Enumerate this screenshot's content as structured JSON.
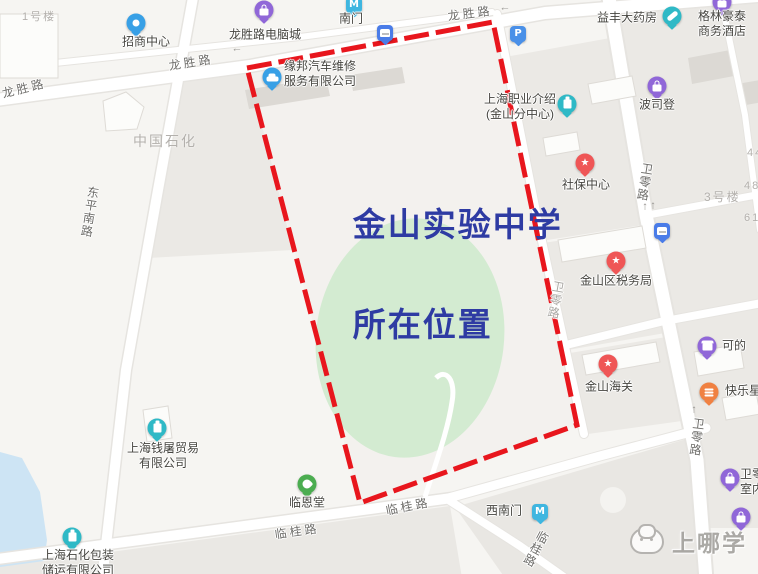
{
  "map": {
    "caption": {
      "line1": "金山实验中学",
      "line2": "所在位置"
    },
    "watermark": {
      "text": "上哪学"
    },
    "colors": {
      "boundary_red": "#e8161d",
      "caption_blue": "#2e3ba3",
      "field_green": "#d3ebd1",
      "water_blue": "#cde4f4",
      "block_grey": "#ebe9e5",
      "road_white": "#ffffff"
    },
    "road_labels": [
      {
        "id": "longsheng-road-west",
        "text": "龙胜路",
        "x": 24,
        "y": 88,
        "rot": -14
      },
      {
        "id": "longsheng-road-mid",
        "text": "龙胜路",
        "x": 191,
        "y": 62,
        "rot": -9
      },
      {
        "id": "longsheng-road-east",
        "text": "龙胜路",
        "x": 470,
        "y": 13,
        "rot": -7
      },
      {
        "id": "dongping-south-road",
        "text": "东平南路",
        "x": 90,
        "y": 212,
        "rot": 9,
        "vertical": true
      },
      {
        "id": "weiling-road-north",
        "text": "卫零路",
        "x": 645,
        "y": 182,
        "rot": 9,
        "vertical": true
      },
      {
        "id": "weiling-road-south",
        "text": "卫零路",
        "x": 697,
        "y": 437,
        "rot": 7,
        "vertical": true
      },
      {
        "id": "weiling-road-inner",
        "text": "卫零路",
        "x": 556,
        "y": 300,
        "rot": 10,
        "vertical": true,
        "muted": true
      },
      {
        "id": "lingui-road-west",
        "text": "临桂路",
        "x": 297,
        "y": 531,
        "rot": -8
      },
      {
        "id": "lingui-road-mid",
        "text": "临桂路",
        "x": 408,
        "y": 506,
        "rot": -11
      },
      {
        "id": "lingui-road-south",
        "text": "临桂路",
        "x": 536,
        "y": 549,
        "rot": 28,
        "vertical": true
      }
    ],
    "area_labels": [
      {
        "id": "sinopec-area",
        "text": "中国石化",
        "x": 133,
        "y": 131,
        "size": 14
      },
      {
        "id": "building-no1",
        "text": "1号楼",
        "x": 22,
        "y": 8,
        "size": 11
      },
      {
        "id": "building-no3",
        "text": "3号楼",
        "x": 704,
        "y": 188,
        "size": 12
      },
      {
        "id": "building-no44",
        "text": "44号",
        "x": 747,
        "y": 144,
        "size": 11
      },
      {
        "id": "building-no48",
        "text": "48号",
        "x": 744,
        "y": 177,
        "size": 11
      },
      {
        "id": "building-no61",
        "text": "61号",
        "x": 744,
        "y": 209,
        "size": 11
      }
    ],
    "arrows": [
      {
        "glyph": "←",
        "x": 237,
        "y": 49
      },
      {
        "glyph": "←",
        "x": 505,
        "y": 8
      },
      {
        "glyph": "↑",
        "x": 645,
        "y": 207
      },
      {
        "glyph": "↑",
        "x": 653,
        "y": 206
      },
      {
        "glyph": "↑",
        "x": 694,
        "y": 410
      }
    ],
    "pois": [
      {
        "id": "zhaoshang-center",
        "label": "招商中心",
        "icon": "dot",
        "color": "#38a0e6",
        "x": 136,
        "y": 23,
        "lx": 146,
        "ly": 42
      },
      {
        "id": "longshenglu-computer-city",
        "label": "龙胜路电脑城",
        "icon": "bag",
        "color": "#9067d8",
        "x": 264,
        "y": 10,
        "lx": 265,
        "ly": 35
      },
      {
        "id": "nanmen-metro",
        "label": "南门",
        "icon": "metro",
        "glyph": "M",
        "color": "#3fb6e0",
        "x": 354,
        "y": 5,
        "lx": 351,
        "ly": 19
      },
      {
        "id": "bus-stop-longsheng",
        "label": "",
        "icon": "bus",
        "color": "#4a7ce8",
        "x": 385,
        "y": 33
      },
      {
        "id": "parking-lot",
        "label": "",
        "icon": "parking",
        "glyph": "P",
        "color": "#4a90e8",
        "x": 518,
        "y": 34
      },
      {
        "id": "yifeng-pharmacy",
        "label": "益丰大药房",
        "icon": "capsule",
        "color": "#2fb9c6",
        "x": 672,
        "y": 16,
        "lx": 627,
        "ly": 18
      },
      {
        "id": "greentree-hotel",
        "label": "格林豪泰\n商务酒店",
        "icon": "bag",
        "color": "#9067d8",
        "x": 722,
        "y": 2,
        "lx": 722,
        "ly": 24
      },
      {
        "id": "yuanbang-auto-repair",
        "label": "缘邦汽车维修\n服务有限公司",
        "icon": "car",
        "color": "#38a0e6",
        "x": 272,
        "y": 77,
        "lx": 320,
        "ly": 74
      },
      {
        "id": "shanghai-job-intro-center",
        "label": "上海职业介绍\n(金山分中心)",
        "icon": "building",
        "color": "#2fb9c6",
        "x": 567,
        "y": 104,
        "lx": 520,
        "ly": 107
      },
      {
        "id": "shebao-center",
        "label": "社保中心",
        "icon": "star",
        "glyph": "★",
        "color": "#ef5656",
        "x": 585,
        "y": 163,
        "lx": 586,
        "ly": 185
      },
      {
        "id": "bosideng",
        "label": "波司登",
        "icon": "bag",
        "color": "#9067d8",
        "x": 657,
        "y": 86,
        "lx": 657,
        "ly": 105
      },
      {
        "id": "jinshan-tax-bureau",
        "label": "金山区税务局",
        "icon": "star",
        "glyph": "★",
        "color": "#ef5656",
        "x": 616,
        "y": 261,
        "lx": 616,
        "ly": 281
      },
      {
        "id": "bus-stop-weiling",
        "label": "",
        "icon": "bus",
        "color": "#4a7ce8",
        "x": 662,
        "y": 231
      },
      {
        "id": "jinshan-customs",
        "label": "金山海关",
        "icon": "star",
        "glyph": "★",
        "color": "#ef5656",
        "x": 608,
        "y": 364,
        "lx": 609,
        "ly": 387
      },
      {
        "id": "kedi-store",
        "label": "可的",
        "icon": "shop",
        "color": "#9067d8",
        "x": 707,
        "y": 346,
        "lx": 734,
        "ly": 346
      },
      {
        "id": "kuailexing",
        "label": "快乐星",
        "icon": "food",
        "color": "#f08142",
        "x": 709,
        "y": 392,
        "lx": 743,
        "ly": 391
      },
      {
        "id": "linentang",
        "label": "临恩堂",
        "icon": "scenic",
        "color": "#4bad50",
        "x": 307,
        "y": 484,
        "lx": 307,
        "ly": 503
      },
      {
        "id": "xinanmen-metro",
        "label": "西南门",
        "icon": "metro",
        "glyph": "M",
        "color": "#3fb6e0",
        "x": 540,
        "y": 512,
        "lx": 504,
        "ly": 511
      },
      {
        "id": "qiantu-trading",
        "label": "上海钱屠贸易\n有限公司",
        "icon": "building",
        "color": "#2fb9c6",
        "x": 157,
        "y": 428,
        "lx": 163,
        "ly": 456
      },
      {
        "id": "shihua-packaging",
        "label": "上海石化包装\n储运有限公司",
        "icon": "building",
        "color": "#2fb9c6",
        "x": 72,
        "y": 537,
        "lx": 78,
        "ly": 563
      },
      {
        "id": "weiling-poi-1",
        "label": "卫零\n室内",
        "icon": "bag",
        "color": "#9067d8",
        "x": 730,
        "y": 478,
        "lx": 752,
        "ly": 482
      },
      {
        "id": "weiling-poi-2",
        "label": "",
        "icon": "bag",
        "color": "#9067d8",
        "x": 741,
        "y": 517
      }
    ]
  }
}
